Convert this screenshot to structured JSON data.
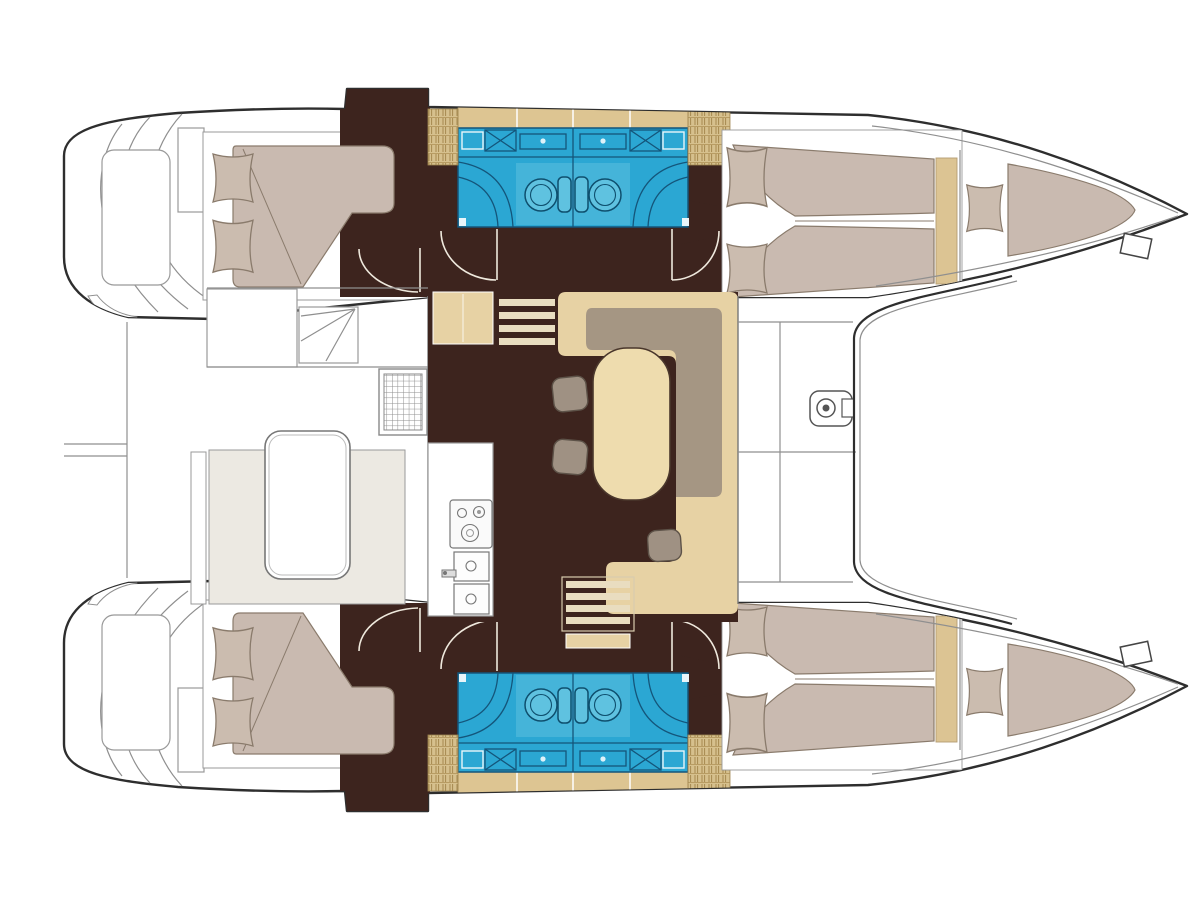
{
  "diagram": {
    "type": "boat-floor-plan",
    "subject": "catamaran-deck-layout",
    "hull_count": 2,
    "double_cabins": 4,
    "bathrooms": 2,
    "regions": [
      {
        "name": "port-hull",
        "contents": [
          "aft-double-cabin",
          "twin-bathroom-block",
          "forward-v-berth-cabin",
          "forepeak-berth",
          "bow-cleat"
        ]
      },
      {
        "name": "starboard-hull",
        "contents": [
          "aft-double-cabin",
          "twin-bathroom-block",
          "forward-v-berth-cabin",
          "forepeak-berth",
          "bow-cleat"
        ]
      },
      {
        "name": "cockpit",
        "contents": [
          "transom-steps",
          "cockpit-bench",
          "corner-steps",
          "deck-grate",
          "cockpit-table",
          "seating-platform"
        ]
      },
      {
        "name": "saloon",
        "contents": [
          "galley-counter",
          "stove",
          "double-sink",
          "companionway-steps-port",
          "companionway-steps-starboard",
          "u-settee",
          "backrest",
          "dinette-table",
          "stools",
          "drawer-chest"
        ]
      },
      {
        "name": "foredeck",
        "contents": [
          "deck-lockers",
          "windlass",
          "trampoline-beam"
        ]
      }
    ]
  },
  "colors": {
    "hull_line": "#2e2e2e",
    "thin_line": "#8f8f8f",
    "floor_dark": "#3d241e",
    "settee_beige": "#e7d2a4",
    "table_cream": "#eedcae",
    "locker_tan": "#ddc592",
    "woven_tan": "#d6c08d",
    "woven_line": "#a5894f",
    "mattress_taupe": "#c9bab0",
    "pillow_taupe": "#cbbcaf",
    "mattress_line": "#8a7b6c",
    "backrest_gray": "#a59683",
    "stool_gray": "#9f9183",
    "bathroom_cyan": "#2ba7d3",
    "bathroom_light": "#5fc2e0",
    "bathroom_line": "#14557a",
    "tread_cream": "#e9ddc0",
    "door_line": "#efe9dd",
    "bench_platform": "#ece9e2",
    "background": "#ffffff"
  }
}
